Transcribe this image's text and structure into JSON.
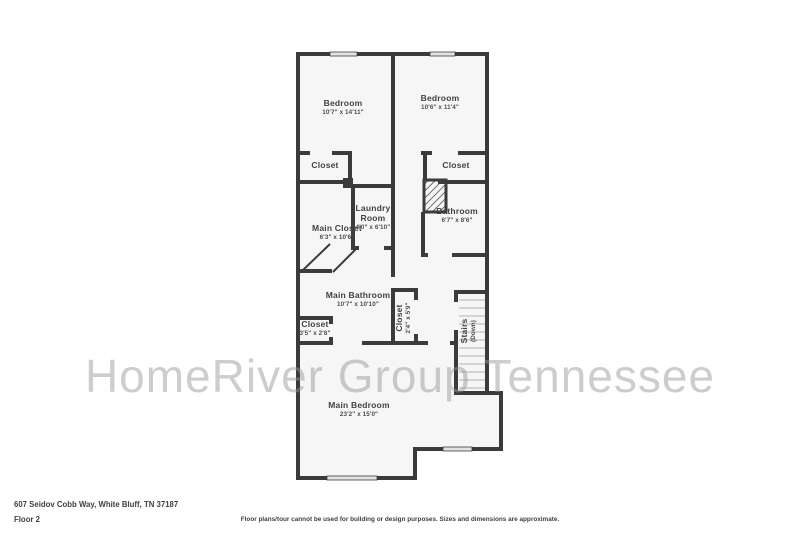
{
  "watermark": "HomeRiver Group Tennessee",
  "footer": {
    "address": "607 Seidov Cobb Way, White Bluff, TN 37187",
    "floor_label": "Floor 2",
    "disclaimer": "Floor plans/tour cannot be used for building or design purposes. Sizes and dimensions are approximate."
  },
  "colors": {
    "wall": "#3b3b3b",
    "floor_fill": "#f6f6f6",
    "window_fill": "#e3e3e3",
    "tread_line": "#c9c9c9",
    "label_text": "#3f4347",
    "watermark_gray": "#bfbfbf"
  },
  "rooms": {
    "bedroom1": {
      "name": "Bedroom",
      "dims": "10'7\" x 14'11\""
    },
    "bedroom2": {
      "name": "Bedroom",
      "dims": "10'6\" x 11'4\""
    },
    "closet_bed1": {
      "name": "Closet"
    },
    "closet_bed2": {
      "name": "Closet"
    },
    "main_closet": {
      "name": "Main Closet",
      "dims": "6'3\" x 10'6\""
    },
    "laundry": {
      "name": "Laundry Room",
      "dims": "4'0\" x 6'10\""
    },
    "bathroom": {
      "name": "Bathroom",
      "dims": "6'7\" x 8'6\""
    },
    "main_bathroom": {
      "name": "Main Bathroom",
      "dims": "10'7\" x 10'10\""
    },
    "closet_hall_small": {
      "name": "Closet",
      "dims": "3'5\" x 2'8\""
    },
    "closet_hall_tall": {
      "name": "Closet",
      "dims": "2'4\" x 5'9\""
    },
    "stairs": {
      "name": "Stairs",
      "dims": "(Down)"
    },
    "main_bedroom": {
      "name": "Main Bedroom",
      "dims": "23'2\" x 15'0\""
    }
  }
}
